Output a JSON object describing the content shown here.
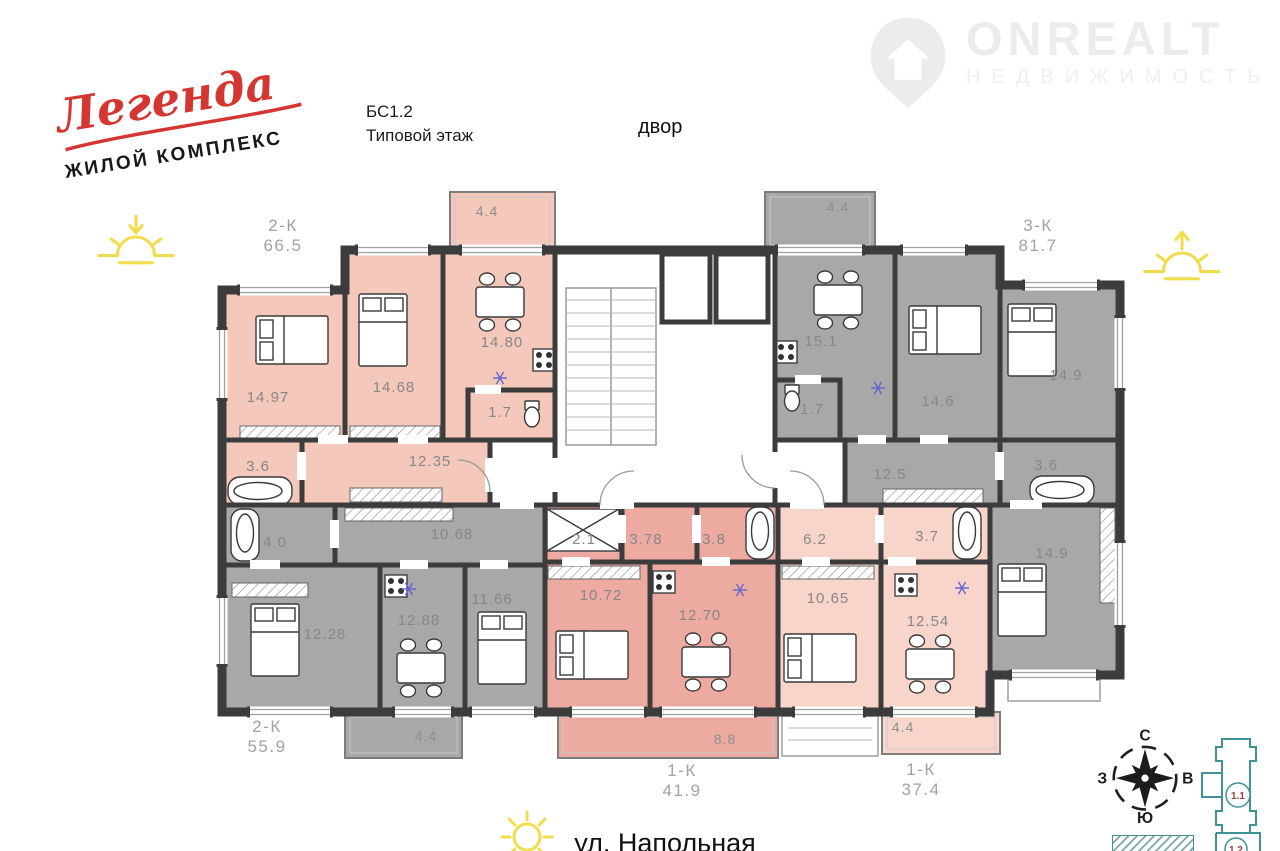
{
  "branding": {
    "logo_script": "Легенда",
    "logo_sub": "ЖИЛОЙ КОМПЛЕКС",
    "watermark": "ONREALT",
    "watermark_sub": "НЕДВИЖИМОСТЬ"
  },
  "plan_info": {
    "block": "БС1.2",
    "floor_type": "Типовой этаж",
    "courtyard": "двор",
    "street": "ул. Напольная"
  },
  "compass": {
    "north": "С",
    "east": "В",
    "south": "Ю",
    "west": "З"
  },
  "site_plan": {
    "current_section": "1.1",
    "next_section": "1.2"
  },
  "colors": {
    "wall": "#3c3c3c",
    "apartment_salmon": "#f4c8ba",
    "apartment_gray": "#a8a8a8",
    "apartment_rose": "#ecaaa1",
    "apartment_light_pink": "#f7d5cb",
    "logo_red": "#d43732",
    "sun_yellow": "#f1dc4e",
    "site_teal": "#3f9296",
    "site_label_red": "#9c3f39",
    "room_label_gray": "#878787"
  },
  "apartments": [
    {
      "id": "2k-66",
      "code": "2-К",
      "total": "66.5",
      "color": "#f4c8ba",
      "label_xy": [
        283,
        231
      ],
      "poly": "222,290 345,290 345,250 555,250 555,440 490,440 490,505 222,505",
      "rooms": [
        {
          "area": "14.97",
          "label": [
            268,
            402
          ],
          "furn": [
            "bed-h",
            292,
            340
          ]
        },
        {
          "area": "14.68",
          "label": [
            394,
            392
          ],
          "furn": [
            "bed-v",
            383,
            330
          ]
        },
        {
          "area": "14.80",
          "label": [
            502,
            347
          ],
          "furn": [
            "table",
            500,
            302
          ]
        },
        {
          "area": "1.7",
          "label": [
            500,
            417
          ],
          "furn": [
            "wc",
            532,
            414
          ]
        },
        {
          "area": "12.35",
          "label": [
            430,
            466
          ],
          "furn": null
        },
        {
          "area": "3.6",
          "label": [
            258,
            471
          ],
          "furn": [
            "bath-h",
            260,
            491
          ]
        }
      ],
      "balcony": {
        "area": "4.4",
        "rect": [
          450,
          192,
          105,
          58
        ],
        "label": [
          487,
          216
        ]
      }
    },
    {
      "id": "3k-81",
      "code": "3-К",
      "total": "81.7",
      "color": "#a8a8a8",
      "label_xy": [
        1038,
        231
      ],
      "poly": "775,250 1000,250 1000,285 1120,285 1120,675 990,675 990,505 845,505 845,440 775,440",
      "rooms": [
        {
          "area": "15.1",
          "label": [
            821,
            346
          ],
          "furn": [
            "table",
            838,
            300
          ]
        },
        {
          "area": "14.6",
          "label": [
            938,
            406
          ],
          "furn": [
            "bed-h",
            945,
            330
          ]
        },
        {
          "area": "14.9",
          "label": [
            1066,
            380
          ],
          "furn": [
            "bed-v",
            1032,
            340
          ]
        },
        {
          "area": "1.7",
          "label": [
            812,
            414
          ],
          "furn": [
            "wc",
            792,
            398
          ]
        },
        {
          "area": "12.5",
          "label": [
            890,
            479
          ],
          "furn": null
        },
        {
          "area": "3.6",
          "label": [
            1046,
            470
          ],
          "furn": [
            "bath-h",
            1062,
            490
          ]
        },
        {
          "area": "14.9",
          "label": [
            1052,
            558
          ],
          "furn": [
            "bed-v",
            1022,
            600
          ]
        }
      ],
      "balcony": {
        "area": "4.4",
        "rect": [
          765,
          192,
          110,
          58
        ],
        "label": [
          838,
          212
        ]
      }
    },
    {
      "id": "2k-55",
      "code": "2-К",
      "total": "55.9",
      "color": "#a8a8a8",
      "label_xy": [
        267,
        732
      ],
      "poly": "222,505 545,505 545,712 222,712",
      "rooms": [
        {
          "area": "4.0",
          "label": [
            275,
            547
          ],
          "furn": [
            "bath-v",
            245,
            535
          ]
        },
        {
          "area": "10.68",
          "label": [
            452,
            539
          ],
          "furn": null
        },
        {
          "area": "12.28",
          "label": [
            325,
            639
          ],
          "furn": [
            "bed-v",
            275,
            640
          ]
        },
        {
          "area": "12.88",
          "label": [
            419,
            625
          ],
          "furn": [
            "table",
            421,
            668
          ]
        },
        {
          "area": "11.66",
          "label": [
            492,
            604
          ],
          "furn": [
            "bed-v",
            502,
            648
          ]
        }
      ],
      "balcony": {
        "area": "4.4",
        "rect": [
          345,
          712,
          117,
          46
        ],
        "label": [
          426,
          741
        ]
      }
    },
    {
      "id": "1k-41",
      "code": "1-К",
      "total": "41.9",
      "color": "#ecaaa1",
      "label_xy": [
        682,
        776
      ],
      "poly": "545,505 778,505 778,712 545,712",
      "rooms": [
        {
          "area": "2.1",
          "label": [
            584,
            544
          ],
          "furn": [
            "ward",
            583,
            530
          ]
        },
        {
          "area": "3.78",
          "label": [
            646,
            544
          ],
          "furn": null
        },
        {
          "area": "3.8",
          "label": [
            714,
            544
          ],
          "furn": [
            "bath-v",
            760,
            533
          ]
        },
        {
          "area": "10.72",
          "label": [
            601,
            600
          ],
          "furn": [
            "bed-h",
            592,
            655
          ]
        },
        {
          "area": "12.70",
          "label": [
            700,
            620
          ],
          "furn": [
            "table",
            706,
            662
          ]
        }
      ],
      "balcony": {
        "area": "8.8",
        "rect": [
          558,
          712,
          220,
          46
        ],
        "label": [
          725,
          744
        ]
      }
    },
    {
      "id": "1k-37",
      "code": "1-К",
      "total": "37.4",
      "color": "#f7d5cb",
      "label_xy": [
        921,
        775
      ],
      "poly": "778,505 990,505 990,712 778,712",
      "rooms": [
        {
          "area": "6.2",
          "label": [
            815,
            544
          ],
          "furn": null
        },
        {
          "area": "3.7",
          "label": [
            927,
            541
          ],
          "furn": [
            "bath-v",
            967,
            533
          ]
        },
        {
          "area": "10.65",
          "label": [
            828,
            603
          ],
          "furn": [
            "bed-h",
            820,
            658
          ]
        },
        {
          "area": "12.54",
          "label": [
            928,
            626
          ],
          "furn": [
            "table",
            930,
            664
          ]
        }
      ],
      "balcony": {
        "area": "4.4",
        "rect": [
          882,
          712,
          118,
          42
        ],
        "label": [
          903,
          732
        ]
      }
    }
  ]
}
